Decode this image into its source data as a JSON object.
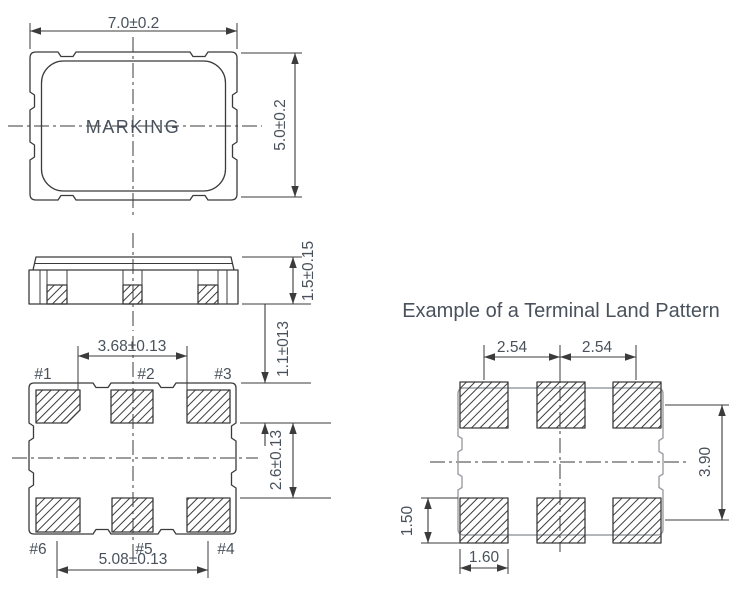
{
  "diagram": {
    "title": "Example of a Terminal Land Pattern",
    "colors": {
      "line": "#3b3b3b",
      "text": "#49525c",
      "gray": "#9b9fa3"
    },
    "top_view": {
      "marking": "MARKING",
      "width_dim": "7.0±0.2",
      "height_dim": "5.0±0.2"
    },
    "side_view": {
      "height_dim": "1.5±0.15"
    },
    "bottom_view": {
      "pad_labels": [
        "#1",
        "#2",
        "#3",
        "#4",
        "#5",
        "#6"
      ],
      "top_span_dim": "3.68±0.13",
      "pad_length_dim": "1.1±013",
      "row_gap_dim": "2.6±0.13",
      "bottom_span_dim": "5.08±0.13"
    },
    "land_pattern": {
      "pitch_dim_left": "2.54",
      "pitch_dim_right": "2.54",
      "row_pitch_dim": "3.90",
      "pad_height_dim": "1.50",
      "pad_width_dim": "1.60"
    }
  }
}
